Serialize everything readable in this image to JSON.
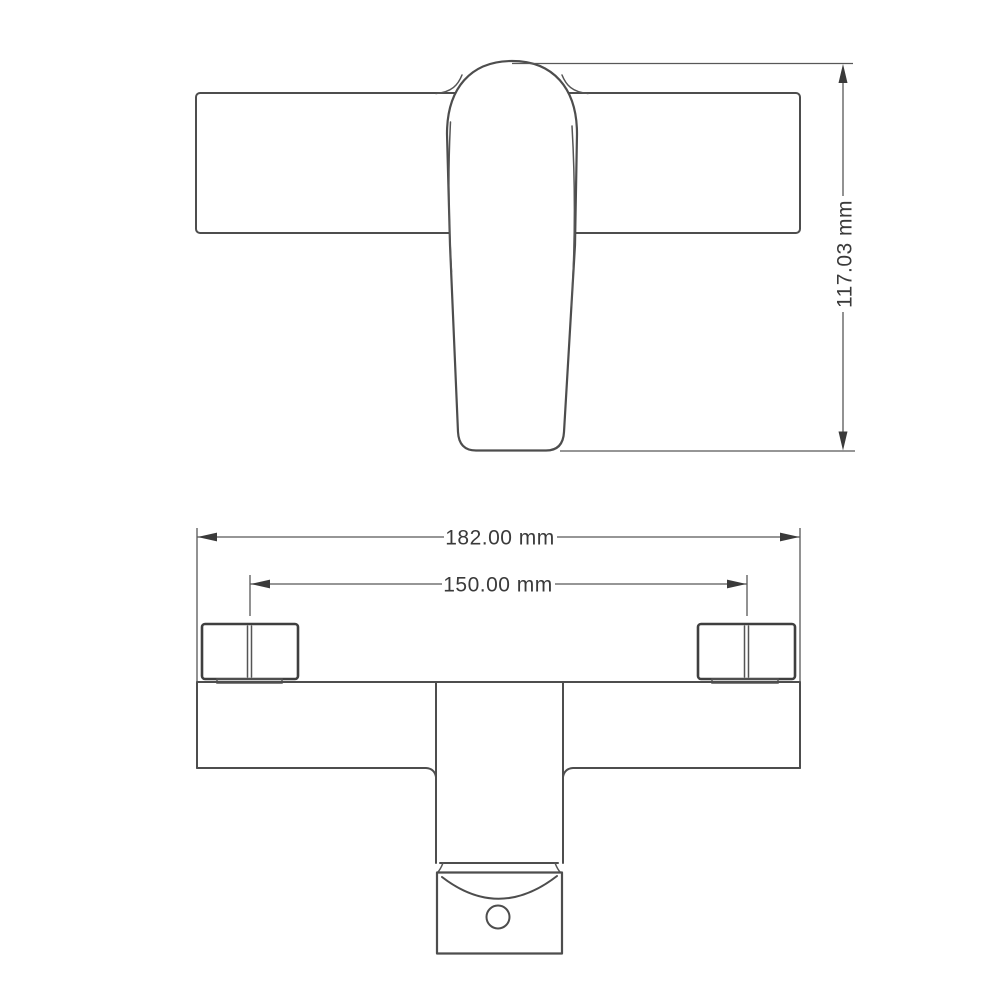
{
  "page": {
    "width": 1000,
    "height": 1000,
    "background": "#ffffff"
  },
  "drawing": {
    "kind": "technical-dimension-drawing",
    "subject": "faucet mixer two-view line drawing",
    "views": {
      "side": {
        "label": "side profile view with lever handle"
      },
      "front": {
        "label": "front elevation view with inlet connectors and outlet"
      }
    },
    "dimensions": {
      "overall_height": {
        "value": "117.03",
        "unit": "mm",
        "label": "117.03 mm",
        "orientation": "vertical"
      },
      "overall_width": {
        "value": "182.00",
        "unit": "mm",
        "label": "182.00 mm",
        "orientation": "horizontal"
      },
      "inlet_spacing": {
        "value": "150.00",
        "unit": "mm",
        "label": "150.00 mm",
        "orientation": "horizontal"
      }
    },
    "colors": {
      "outline": "#4d4d4d",
      "outline_dark": "#3f3f3f",
      "dimension_line": "#585858",
      "text": "#3a3a3a",
      "background": "#ffffff"
    }
  }
}
